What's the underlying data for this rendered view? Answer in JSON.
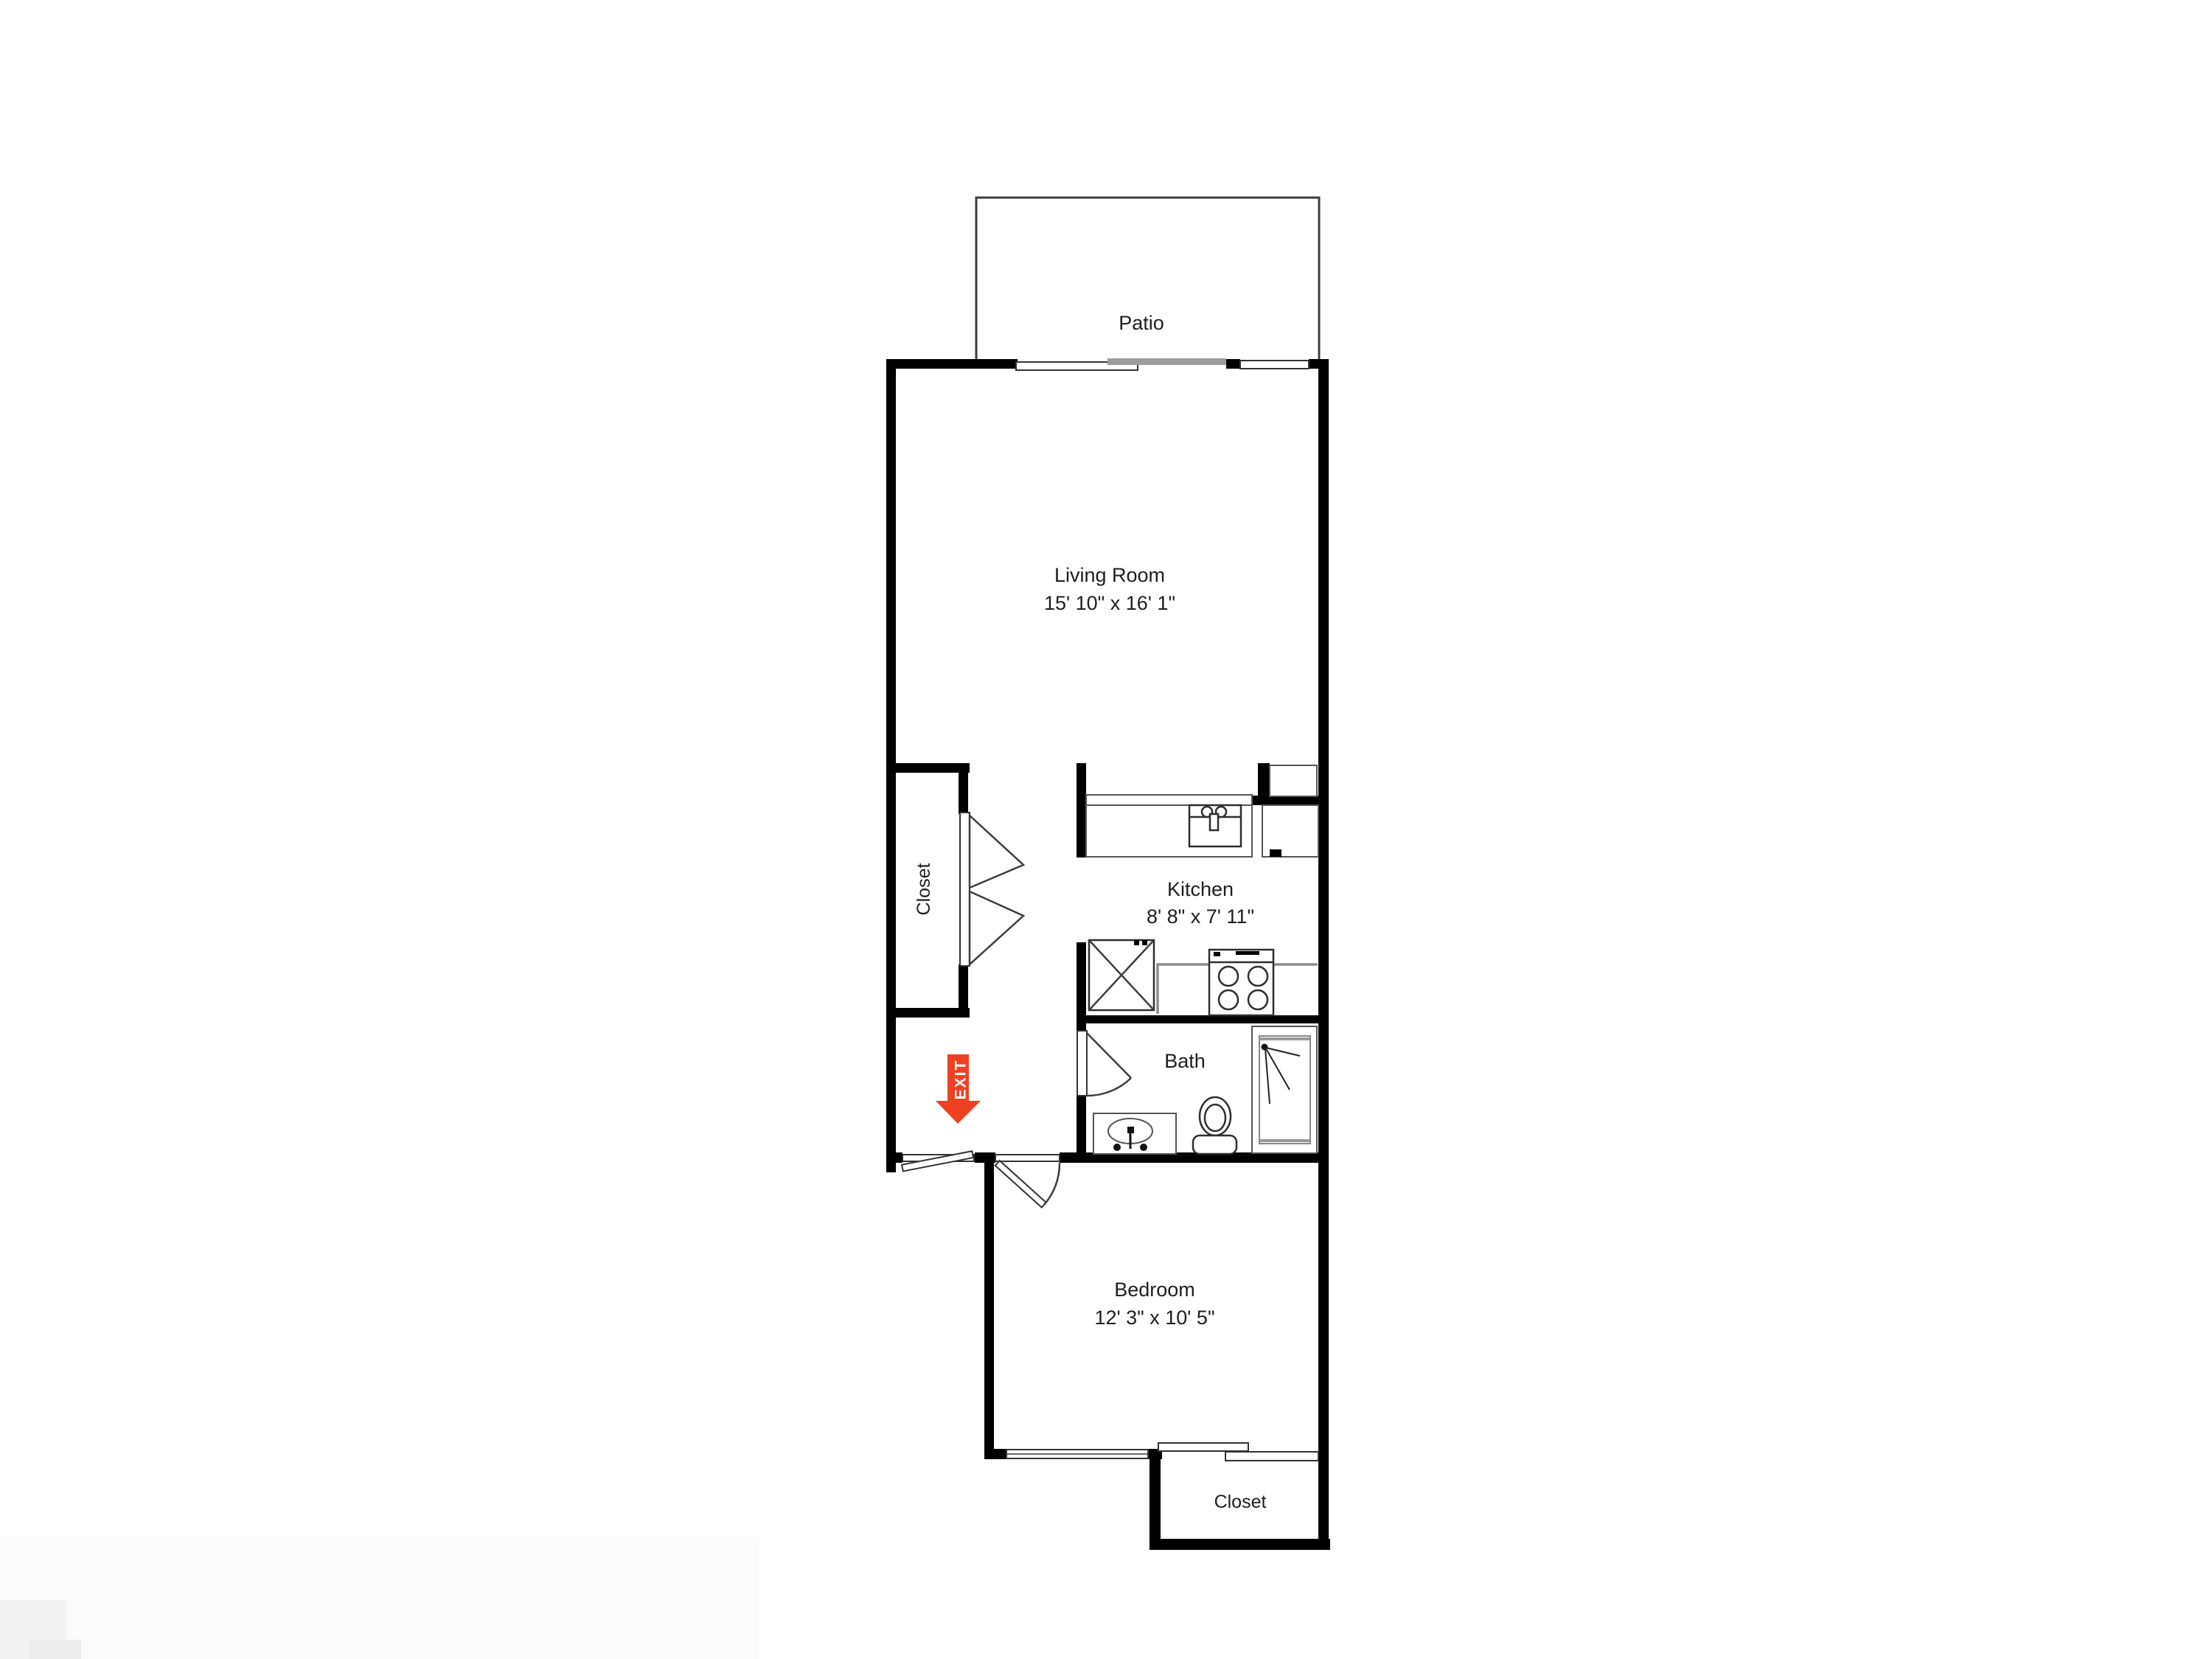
{
  "colors": {
    "background": "#ffffff",
    "walls": "#000000",
    "thin_lines": "#3d3d3d",
    "counter_gray": "#8c8c8c",
    "slider_gray": "#9c9c9c",
    "exit_arrow_red": "#ee4123",
    "exit_text": "#ffffff",
    "label_text": "#1e1e1e"
  },
  "rooms": {
    "patio": {
      "label": "Patio"
    },
    "living_room": {
      "label": "Living Room",
      "dimensions": "15' 10\" x 16' 1\""
    },
    "hall_closet": {
      "label": "Closet"
    },
    "kitchen": {
      "label": "Kitchen",
      "dimensions": "8' 8\" x 7' 11\""
    },
    "bath": {
      "label": "Bath"
    },
    "bedroom": {
      "label": "Bedroom",
      "dimensions": "12' 3\" x 10' 5\""
    },
    "bedroom_closet": {
      "label": "Closet"
    }
  },
  "exit_sign": {
    "label": "EXIT"
  }
}
